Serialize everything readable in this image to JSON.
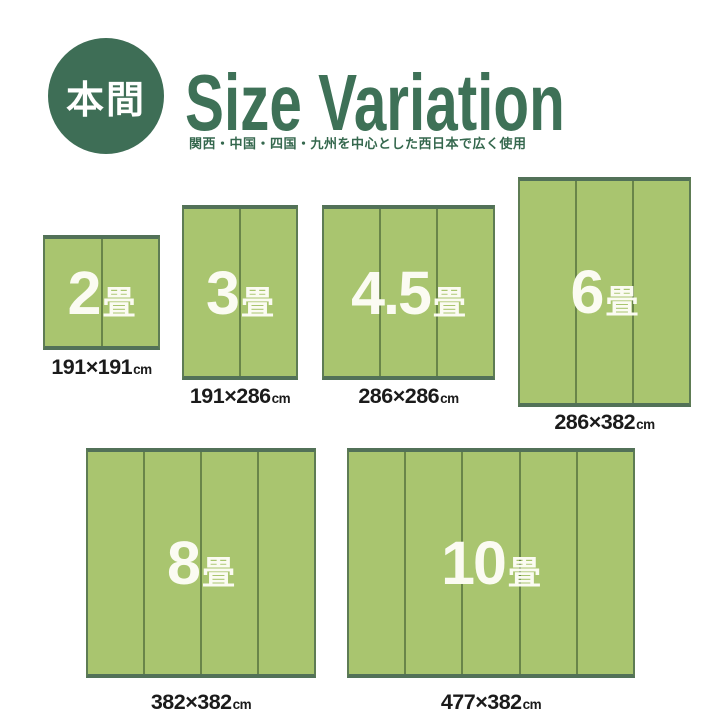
{
  "header": {
    "badge_label": "本間",
    "title": "Size Variation",
    "subtitle": "関西・中国・四国・九州を中心とした西日本で広く使用"
  },
  "colors": {
    "brand_green": "#3e7157",
    "badge_green": "#3e6e56",
    "mat_fill": "#a9c56f",
    "mat_border": "#527158",
    "mat_divider": "#698549",
    "caption_text": "#1b1b1b"
  },
  "mats": [
    {
      "name": "2jo",
      "num": "2",
      "unit": "畳",
      "size": "191×191",
      "size_unit": "cm",
      "panels": 2,
      "width_cm": 191,
      "height_cm": 191
    },
    {
      "name": "3jo",
      "num": "3",
      "unit": "畳",
      "size": "191×286",
      "size_unit": "cm",
      "panels": 2,
      "width_cm": 191,
      "height_cm": 286
    },
    {
      "name": "4_5jo",
      "num": "4.5",
      "unit": "畳",
      "size": "286×286",
      "size_unit": "cm",
      "panels": 3,
      "width_cm": 286,
      "height_cm": 286
    },
    {
      "name": "6jo",
      "num": "6",
      "unit": "畳",
      "size": "286×382",
      "size_unit": "cm",
      "panels": 3,
      "width_cm": 286,
      "height_cm": 382
    },
    {
      "name": "8jo",
      "num": "8",
      "unit": "畳",
      "size": "382×382",
      "size_unit": "cm",
      "panels": 4,
      "width_cm": 382,
      "height_cm": 382
    },
    {
      "name": "10jo",
      "num": "10",
      "unit": "畳",
      "size": "477×382",
      "size_unit": "cm",
      "panels": 5,
      "width_cm": 477,
      "height_cm": 382
    }
  ]
}
